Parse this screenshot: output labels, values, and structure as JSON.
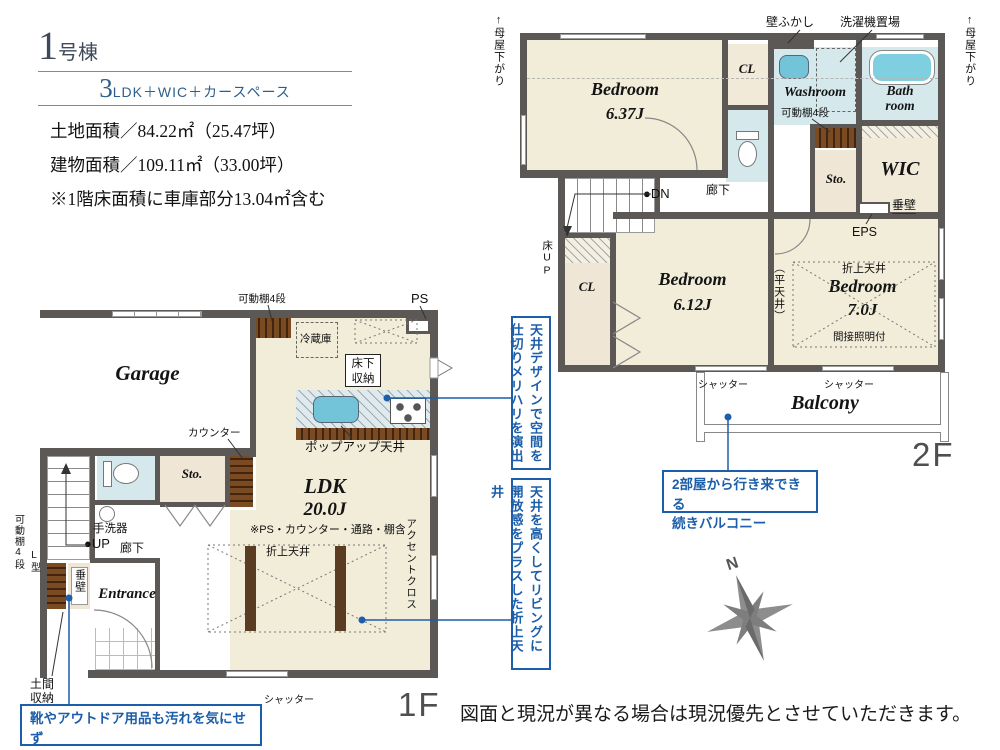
{
  "header": {
    "building_number": "1",
    "building_suffix": "号棟",
    "plan_number": "3",
    "plan_suffix": "LDK＋WIC＋カースペース",
    "land_area": "土地面積／84.22㎡（25.47坪）",
    "building_area": "建物面積／109.11㎡（33.00坪）",
    "area_note": "※1階床面積に車庫部分13.04㎡含む"
  },
  "floor2": {
    "floor_label": "2F",
    "moyasagari_arrow": "↑",
    "moyasagari_left": "母屋下がり",
    "moyasagari_right": "母屋下がり",
    "kabefukashi_label": "壁ふかし",
    "sentakuki_label": "洗濯機置場",
    "bedroom1_name": "Bedroom",
    "bedroom1_size": "6.37J",
    "cl1_label": "CL",
    "washroom_label": "Washroom",
    "bathroom_label_1": "Bath",
    "bathroom_label_2": "room",
    "kadoudana_label": "可動棚4段",
    "sto_label": "Sto.",
    "wic_label": "WIC",
    "tarekabe_label": "垂壁",
    "eps_label": "EPS",
    "dn_label": "●DN",
    "rouka_label": "廊下",
    "yukaup_label": "床UP",
    "cl2_label": "CL",
    "bedroom2_name": "Bedroom",
    "bedroom2_size": "6.12J",
    "hiratenjou_label": "（平天井）",
    "oriage_label": "折上天井",
    "bedroom3_name": "Bedroom",
    "bedroom3_size": "7.0J",
    "kansetsu_label": "間接照明付",
    "shutter1_label": "シャッター",
    "shutter2_label": "シャッター",
    "balcony_label": "Balcony"
  },
  "floor1": {
    "floor_label": "1F",
    "kadoudana_top_label": "可動棚4段",
    "ps_label": "PS",
    "reizouko_label": "冷蔵庫",
    "yukashita_label_1": "床下",
    "yukashita_label_2": "収納",
    "garage_label": "Garage",
    "counter_label": "カウンター",
    "popup_label": "ポップアップ天井",
    "sto_label": "Sto.",
    "ldk_name": "LDK",
    "ldk_size": "20.0J",
    "ldk_note": "※PS・カウンター・通路・棚含",
    "oriage_label": "折上天井",
    "accent_label": "アクセントクロス",
    "tearai_label": "手洗器",
    "up_label": "●UP",
    "rouka_label": "廊下",
    "lgata_label": "L型",
    "kadoudana_left_label": "可動棚4段",
    "tarekabe_label": "垂壁",
    "entrance_label": "Entrance",
    "doma_label_1": "土間",
    "doma_label_2": "収納",
    "shutter_label": "シャッター"
  },
  "callouts": {
    "ceiling_design": {
      "lines": [
        "天井デザインで空間を",
        "仕切りメリハリを演出"
      ]
    },
    "ceiling_height": {
      "lines": [
        "天井を高くしてリビングに",
        "開放感をプラスした折上天井"
      ]
    },
    "balcony": {
      "lines": [
        "2部屋から行き来できる",
        "続きバルコニー"
      ]
    },
    "entrance": {
      "lines": [
        "靴やアウトドア用品も汚れを気にせず",
        "収納でき玄関スッキリ"
      ]
    }
  },
  "compass": {
    "north_label": "N"
  },
  "footer": {
    "disclaimer": "図面と現況が異なる場合は現況優先とさせていただきます。"
  }
}
